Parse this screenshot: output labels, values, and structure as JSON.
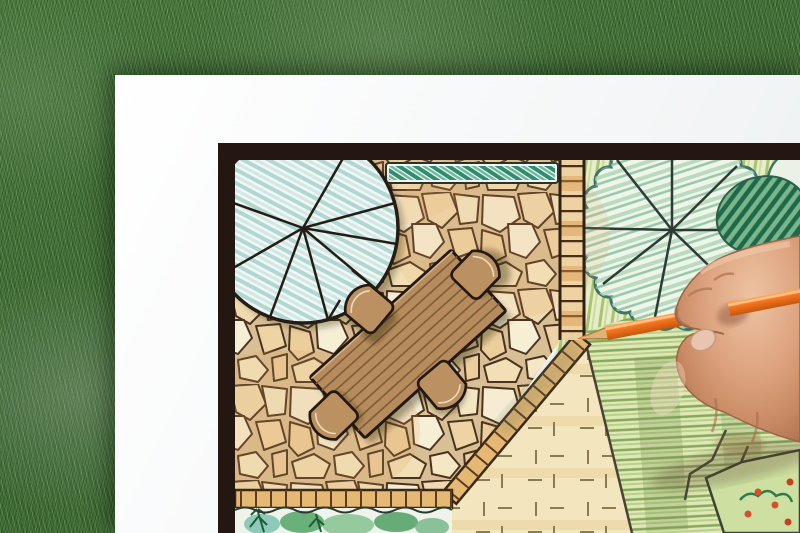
{
  "scene": {
    "title": "Landscape architect drawing a garden plan",
    "setting": "White drawing paper lying on a green grass lawn",
    "action": "A hand draws on the plan with an orange colored pencil"
  },
  "objects": {
    "grass_background": {
      "label": "Grass lawn background",
      "color": "#3e6a33"
    },
    "paper_sheet": {
      "label": "White drawing paper",
      "color": "#f4f6f7"
    },
    "plan_frame": {
      "label": "Dark border frame of the garden plan",
      "color": "#241712"
    },
    "patio": {
      "label": "Irregular flagstone patio",
      "stone_color": "#f2e3bd",
      "joint_color": "#4a3220"
    },
    "dining_table": {
      "label": "Rectangular wooden plank table symbol",
      "color": "#b78c5c"
    },
    "chairs": {
      "label": "Four rounded patio chairs",
      "count": 4,
      "color": "#bb9161"
    },
    "tree_left": {
      "label": "Large round tree canopy symbol with teal hatching",
      "hatch_color": "#a9d3cd"
    },
    "tree_right": {
      "label": "Scalloped tree canopy symbol with radiating branches",
      "outline_color": "#3d7566"
    },
    "hedge": {
      "label": "Clipped hedge strip along top edge",
      "color": "#2e8d70"
    },
    "shrub": {
      "label": "Dark green hatched shrub",
      "color": "#1d6a4b"
    },
    "brick_edge": {
      "label": "Brick paver border and path",
      "color": "#e5b873"
    },
    "planting_bed": {
      "label": "Planting bed with ferns and shrubs",
      "color": "#5aa86f"
    },
    "lawn_khaki": {
      "label": "Paved/gravel area with tick marks",
      "color": "#f3e5bd"
    },
    "lawn_green": {
      "label": "Lawn with green pencil hatching",
      "color": "#9dbb6e"
    },
    "flower_bed": {
      "label": "Corner flower bed with red blooms",
      "flower_color": "#d8502a"
    },
    "pencil": {
      "label": "Orange colored pencil",
      "body_color": "#f4731d",
      "wood_color": "#dfb276"
    },
    "hand": {
      "label": "Artist's hand holding the pencil",
      "skin_color": "#d8a184"
    }
  }
}
